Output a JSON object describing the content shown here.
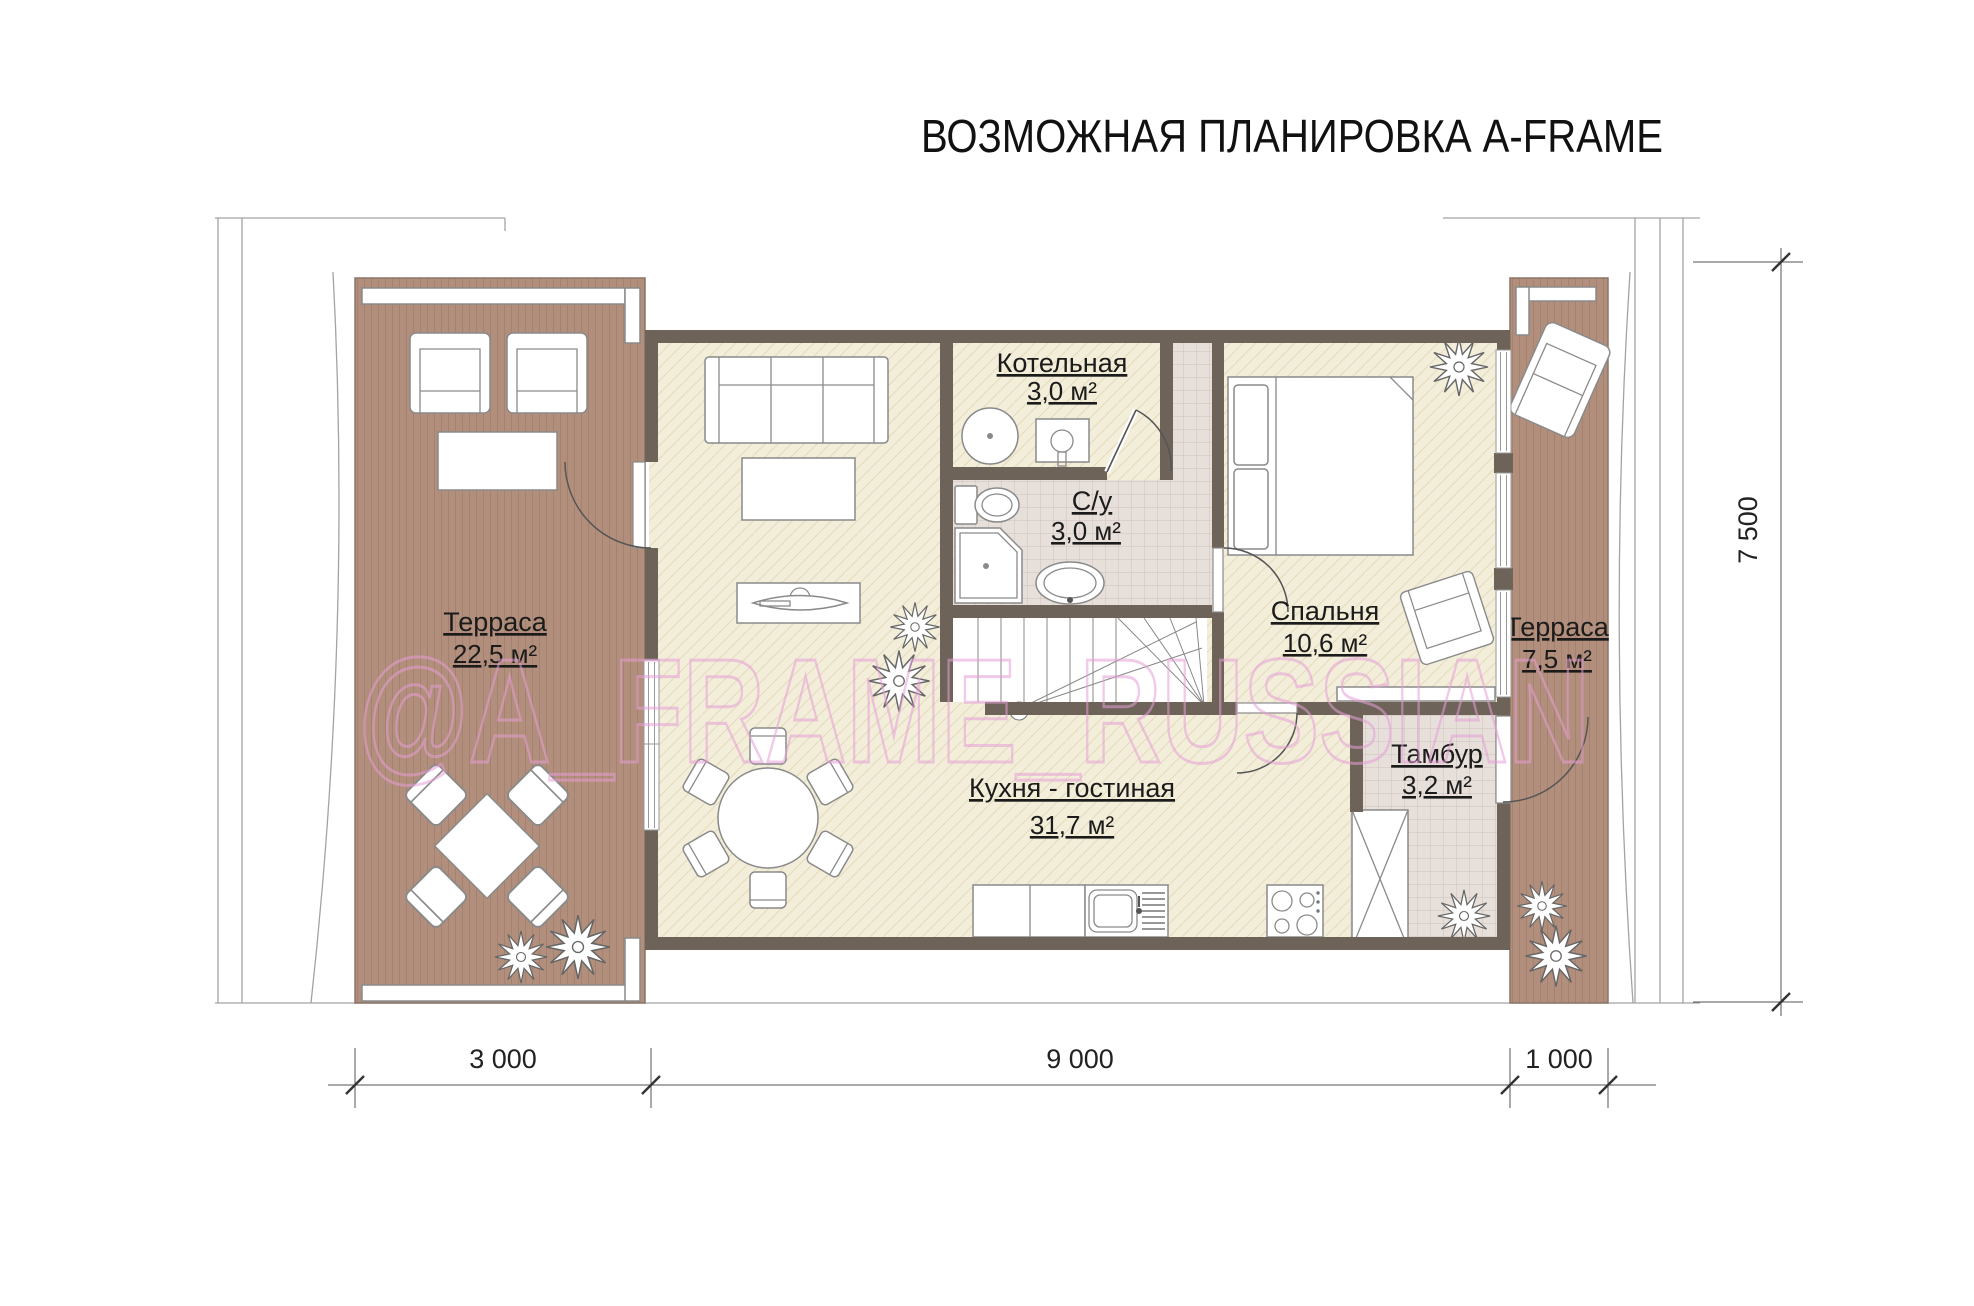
{
  "title": "ВОЗМОЖНАЯ ПЛАНИРОВКА A-FRAME",
  "watermark": "@A_FRAME_RUSSIAN",
  "rooms": {
    "terrace_left": {
      "label": "Терраса",
      "area": "22,5 м²"
    },
    "kitchen_living": {
      "label": "Кухня - гостиная",
      "area": "31,7 м²"
    },
    "boiler": {
      "label": "Котельная",
      "area": "3,0 м²"
    },
    "bathroom": {
      "label": "С/у",
      "area": "3,0 м²"
    },
    "bedroom": {
      "label": "Спальня",
      "area": "10,6 м²"
    },
    "vestibule": {
      "label": "Тамбур",
      "area": "3,2 м²"
    },
    "terrace_right": {
      "label": "Терраса",
      "area": "7,5 м²"
    }
  },
  "dimensions": {
    "width_terrace_left": "3 000",
    "width_house": "9 000",
    "width_terrace_right": "1 000",
    "height_total": "7 500"
  },
  "colors": {
    "wall": "#6e6358",
    "floor_wood": "#f3eeda",
    "terrace_deck": "#b28f7c",
    "tile": "#e7dfda",
    "watermark_pink": "#e59fd6"
  }
}
